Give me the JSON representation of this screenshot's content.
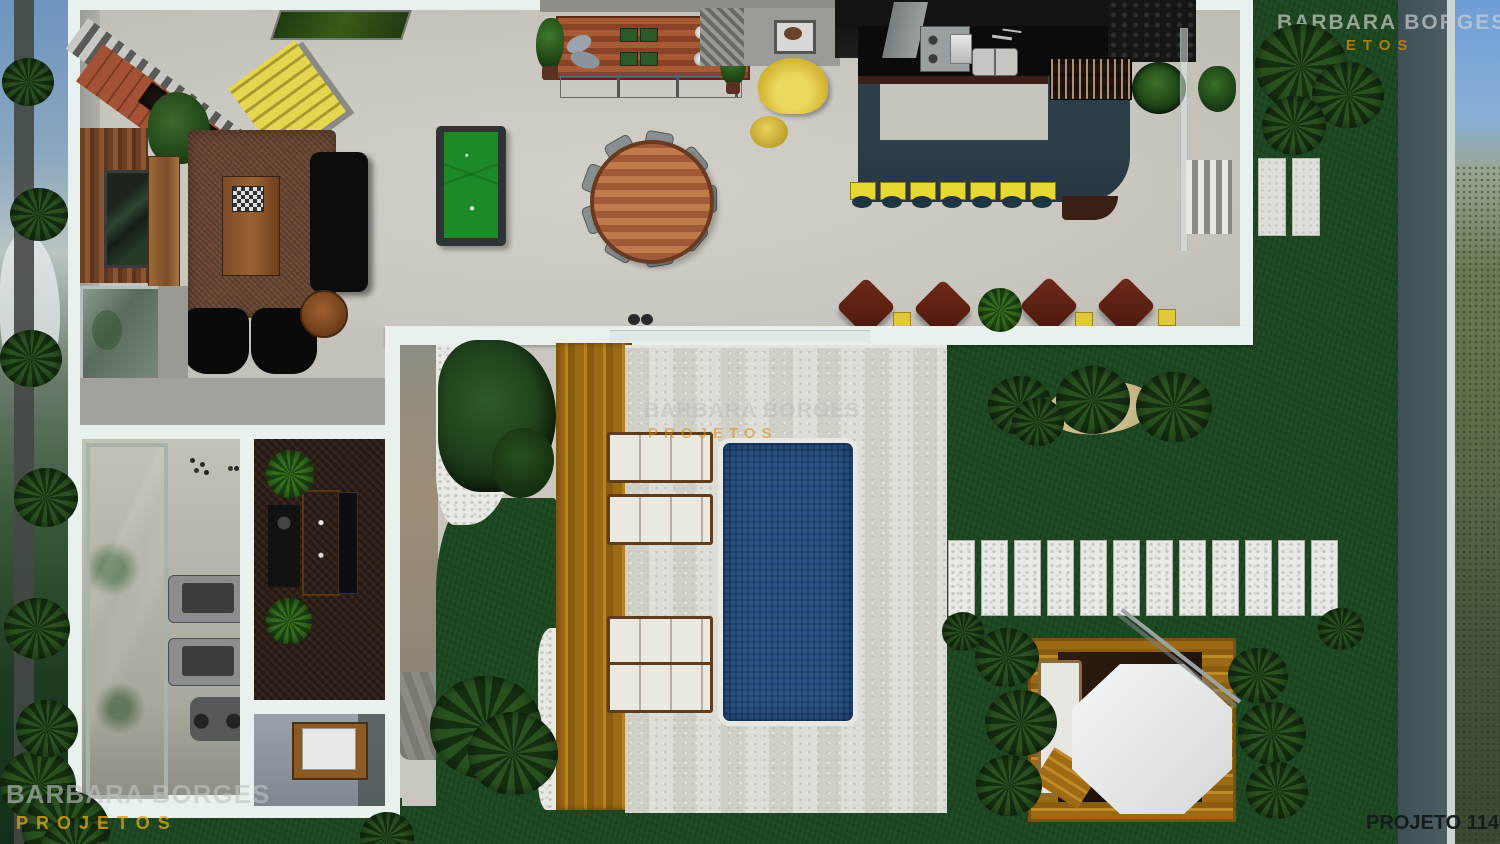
{
  "watermarks": {
    "top_right": {
      "brand": "BARBARA BORGES",
      "sub": "PROJETOS"
    },
    "center": {
      "brand": "BARBARA BORGES",
      "sub": "PROJETOS"
    },
    "bottom_left": {
      "brand": "BARBARA BORGES",
      "sub": "PROJETOS"
    },
    "project_code": "PROJETO 114"
  },
  "palette": {
    "grass": "#1d4822",
    "floor": "#c9c7bf",
    "wall_frame": "#e9f1ee",
    "pool_water": "#2b5687",
    "deck_wood": "#b07818",
    "travertine": "#d9d9d3",
    "bar_counter_slate": "#2e3e48",
    "stool_yellow": "#e8d832",
    "billiard_green": "#1d8a28",
    "armchair_brown": "#5a2014",
    "watermark_gray": "#c0c0c0",
    "watermark_orange": "#c8860a"
  },
  "scene": {
    "type": "architectural-floorplan-3d-render",
    "rooms": [
      {
        "name": "living-room",
        "objects": [
          "tv-wood-panel",
          "black-sofa",
          "black-armchairs",
          "shag-rug",
          "coffee-table-chessboard",
          "stone-fireplace",
          "yellow-staircase",
          "wall-painting",
          "glass-floor-panel"
        ]
      },
      {
        "name": "game-hall",
        "objects": [
          "billiard-table",
          "round-dining-table",
          "dining-chairs",
          "wood-sideboard",
          "yellow-armchair",
          "yellow-pouf"
        ]
      },
      {
        "name": "kitchen-bar",
        "objects": [
          "black-counter",
          "stove",
          "sink",
          "slate-bar-counter",
          "bar-stools",
          "wine-rack",
          "potted-plants"
        ]
      },
      {
        "name": "lounge-row",
        "objects": [
          "brown-armchairs",
          "yellow-side-tables",
          "spiky-plant"
        ]
      },
      {
        "name": "gym",
        "objects": [
          "mirror-wall",
          "treadmills",
          "exercise-bike",
          "dumbbells"
        ]
      },
      {
        "name": "bar-room",
        "objects": [
          "wood-counter",
          "speaker-rack",
          "plants",
          "tv-panel"
        ]
      },
      {
        "name": "bathroom",
        "objects": [
          "wood-vanity",
          "white-sink"
        ]
      },
      {
        "name": "pool-patio",
        "objects": [
          "swimming-pool",
          "sun-loungers",
          "wood-deck",
          "pebble-beds",
          "shrubs",
          "travertine-floor"
        ]
      },
      {
        "name": "garden",
        "objects": [
          "stepping-stones",
          "palm-trees",
          "garden-tiles",
          "gazebo-deck",
          "white-parasol",
          "garden-lounger",
          "ferns"
        ]
      }
    ],
    "counts": {
      "bar_stools": 7,
      "dining_chairs": 9,
      "sun_loungers": 4,
      "stepping_stones": 12,
      "lounge_armchairs": 4,
      "yellow_side_tables": 3,
      "garden_tiles": 2
    }
  }
}
